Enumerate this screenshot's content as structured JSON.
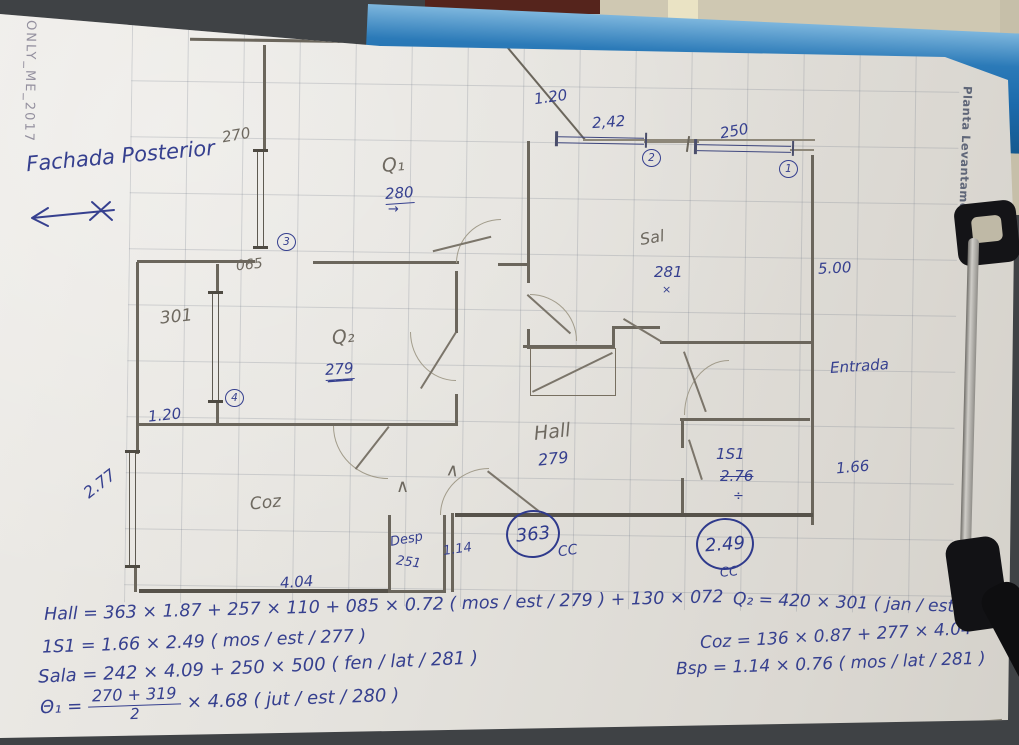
{
  "photo": {
    "watermark": "ONLY_ME_2017",
    "side_text": "Planta Levantamento"
  },
  "notes": {
    "facade": "Fachada Posterior"
  },
  "rooms": {
    "q1": "Q₁",
    "q2": "Q₂",
    "sala": "Sal",
    "hall": "Hall",
    "coz": "Coz",
    "desp": "Desp",
    "is1": "1S1",
    "entry": "Entrada"
  },
  "dims": {
    "top_width": "4.70",
    "win_270": "270",
    "opening_120_top": "1.20",
    "win_242": "2,42",
    "win_250": "250",
    "len_500": "5.00",
    "opening_065": "065",
    "win_301": "301",
    "opening_120_left": "1.20",
    "win_277": "2.77",
    "coz_width": "4.04",
    "desp_height": "251",
    "desp_width": "1.14",
    "is1_width": "1.66"
  },
  "heights": {
    "q1": "280",
    "q1_arrow": "→",
    "sala": "281",
    "sala_mark": "×",
    "q2": "279",
    "hall": "279",
    "is1_old": "2.76",
    "is1_div": "÷",
    "cc_hall": "363",
    "cc_is1": "2.49",
    "cc_label": "CC"
  },
  "refs": {
    "r1": "1",
    "r2": "2",
    "r3": "3",
    "r4": "4"
  },
  "formulas": {
    "hall": "Hall = 363 × 1.87 + 257 × 110 + 085 × 0.72 ( mos / est / 279 ) + 130 × 072",
    "is1": "1S1 = 1.66 × 2.49 ( mos / est / 277 )",
    "sala": "Sala = 242 × 4.09 + 250 × 500 ( fen / lat / 281 )",
    "q1_lhs": "Θ₁ =",
    "q1_num": "270 + 319",
    "q1_den": "2",
    "q1_rhs": "× 4.68  ( jut / est / 280 )",
    "q2": "Q₂ = 420 × 301 ( jan / est / 279 )",
    "coz": "Coz = 136 × 0.87 + 277 × 4.04",
    "bsp": "Bsp = 1.14 × 0.76 ( mos / lat / 281 )"
  }
}
